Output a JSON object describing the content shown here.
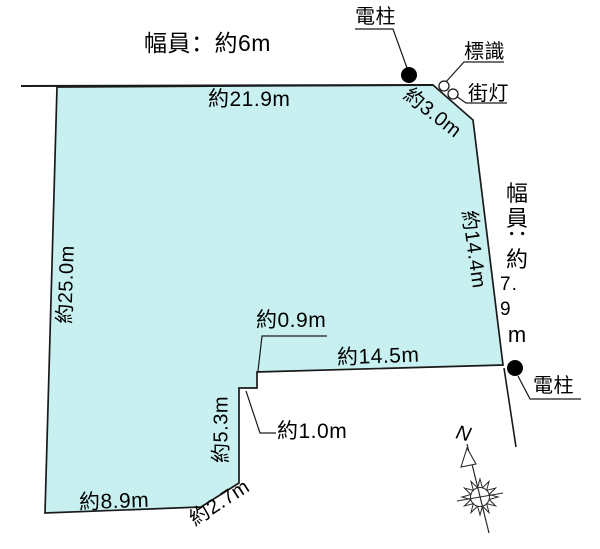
{
  "road_info": {
    "top_width_label": "幅員：約6m",
    "right_width_label": "幅員：約7.9m",
    "right_width_parts": [
      "幅",
      "員",
      "：",
      "約",
      "7. 9",
      "m"
    ]
  },
  "dimensions": {
    "top_edge": "約21.9m",
    "ne_corner_cut": "約3.0m",
    "right_edge": "約14.4m",
    "left_edge": "約25.0m",
    "inner_bottom_edge": "約14.5m",
    "notch_step_depth": "約0.9m",
    "notch_step_width": "約1.0m",
    "notch_side_edge": "約5.3m",
    "bottom_edge": "約8.9m",
    "sw_corner_cut": "約2.7m"
  },
  "markers": {
    "utility_pole_top": "電柱",
    "road_sign": "標識",
    "street_light": "街灯",
    "utility_pole_bottom": "電柱",
    "compass_north": "N"
  },
  "colors": {
    "parcel_fill": "#c8f0f0",
    "line": "#1a1a1a"
  }
}
